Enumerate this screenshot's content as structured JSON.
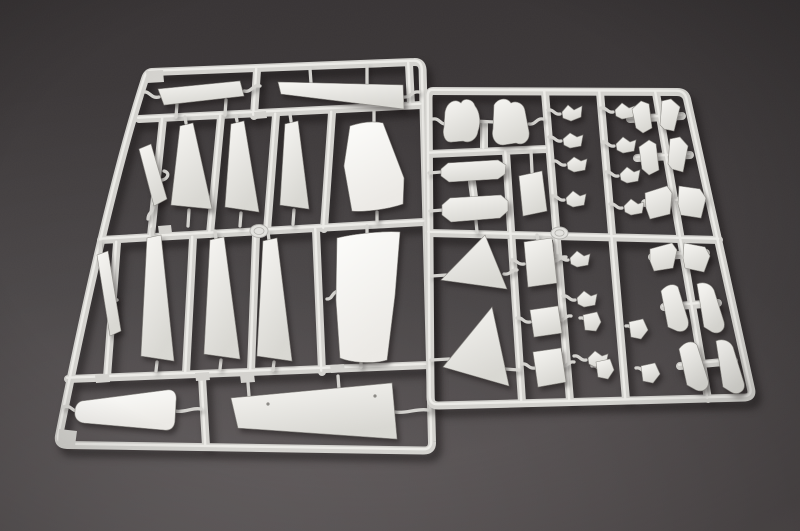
{
  "scene": {
    "type": "photograph",
    "subject": "Unassembled plastic model kit: two light-gray injection-molded sprues (runner frames with unpainted parts) lying on a dark gray studio surface",
    "left_sprue": {
      "name": "large-parts sprue",
      "description": "Tilted rectangular runner frame holding large airframe pieces: wing planks, tapered blade panels, a curved deck panel, a rounded nose half and a long tapered plank",
      "part_count": 14,
      "gate_disc": "round molding disc at crossbar junction"
    },
    "right_sprue": {
      "name": "small-parts sprue",
      "description": "Upright runner frame densely packed with small detail parts: intake halves, slotted plates, delta fins, door panels, linkages, brackets and six pairs of swept fin blades",
      "part_count": 31,
      "gate_disc": "round molding disc at crossbar junction"
    }
  },
  "colors": {
    "background_top": "#383435",
    "background_mid": "#433f40",
    "background_bottom": "#554f50",
    "plastic_bar": "#d3d2ce",
    "plastic_highlight": "#f1f0ec",
    "part_light": "#f7f6f3",
    "part_dark": "#d8d7d2",
    "bright_light": "#fdfdfb",
    "bright_dark": "#ebe9e5",
    "part_edge": "#8f8d88",
    "hole_color": "#8a8884",
    "disc_fill": "#e2e1dd",
    "disc_rim": "#b4b3af"
  }
}
